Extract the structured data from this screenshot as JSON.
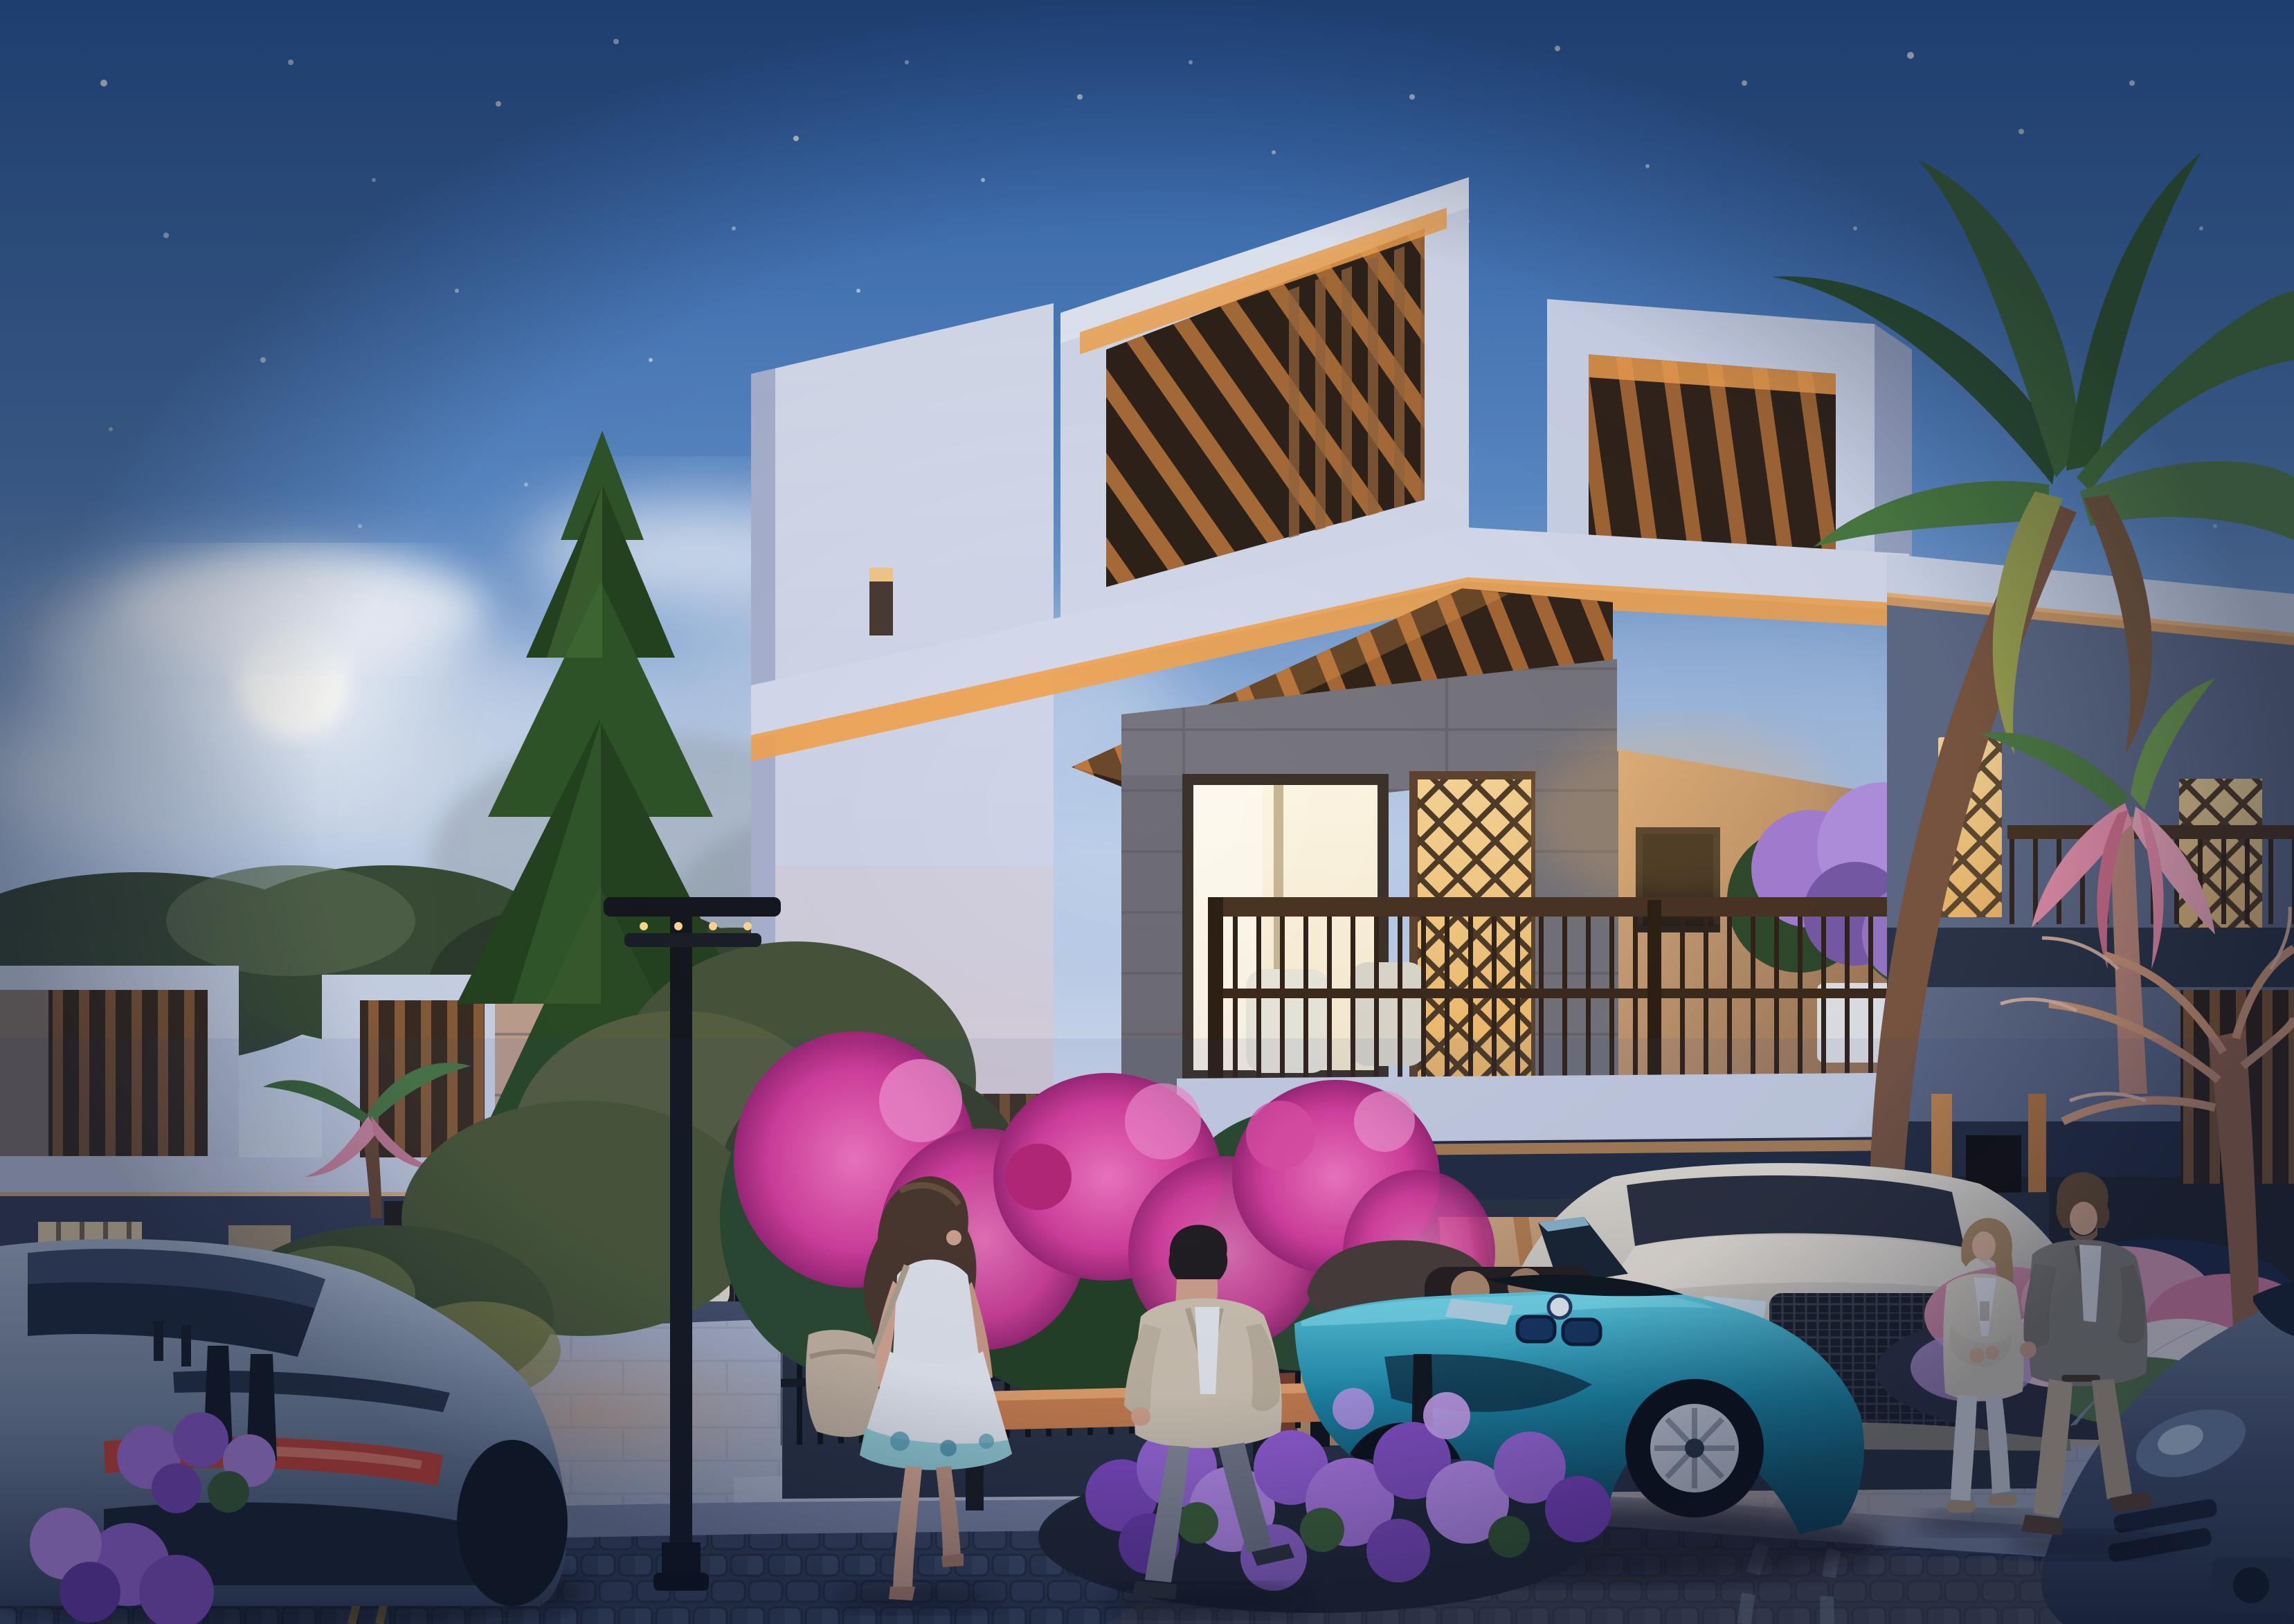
{
  "meta": {
    "title": "Twilight townhouse community - architectural rendering",
    "type": "photorealistic architectural visualization",
    "time_of_day": "dusk"
  },
  "palette": {
    "skyTop": "#2d5fa6",
    "skyMid": "#5b8ac6",
    "skyLow": "#a9c0e2",
    "horizon": "#dde5f2",
    "moonCore": "#fefefb",
    "cloud": "#e6edf8",
    "treeDark": "#2a4426",
    "treeMid": "#3a5c31",
    "treeLight": "#54804a",
    "dryTree": "#9fa9b4",
    "villaWhite": "#d8deee",
    "villaShade": "#a9b2cf",
    "fasciaGlow": "#f3a44f",
    "woodSlat": "#b5743c",
    "woodDark": "#6e4626",
    "stone": "#77767e",
    "windowGlow": "#f8ead0",
    "latticeGlow": "#efb969",
    "warmWall": "#c49a6e",
    "railWood": "#3c2b1d",
    "balconyFlower": "#a77fd4",
    "hedgePink": "#e03f9f",
    "hedgePinkLight": "#ff7ac5",
    "hedgeLeaf": "#2b4a2b",
    "hydrangea": "#a169dd",
    "hydrangeaLight": "#c18ff0",
    "hydrangeaDeep": "#7a3fbd",
    "leafGreen": "#3e6332",
    "benchWood": "#cf7f49",
    "iron": "#111419",
    "pavement": "#aab1c4",
    "curb": "#7d86a2",
    "cobble": "#333d52",
    "roadWarm": "#6e5e50",
    "laneYellow": "#d7a63e",
    "i8Teal": "#1a89a6",
    "i8TealHi": "#62d2e4",
    "i8Dark": "#0b3e52",
    "suvWhite": "#d9d2c6",
    "grilleDark": "#1a1d22",
    "amgGrey": "#8496ad",
    "amgTail": "#e0452e",
    "porsche": "#475571",
    "skin": "#dcab90",
    "hairBrown": "#4d3728",
    "hairBlond": "#b08c5f",
    "dressWhite": "#eceef2",
    "bagBeige": "#c9b7a0",
    "jacketBeige": "#d7cab3",
    "trouserGrey": "#8b8f9a",
    "blazerGrey": "#8e897f",
    "chinoBeige": "#c8b698",
    "pantsWhite": "#e9eaee",
    "cardiganCream": "#e5dcc9",
    "lampBlack": "#14171d",
    "palmGreen": "#3f6a39",
    "palmGreenDark": "#2c5030",
    "palmPink": "#ec93ad",
    "palmTrunk": "#7b5640",
    "pinkFlowerBed": "#f0aac6",
    "bareTree": "#d39a78"
  },
  "scene": {
    "setting": "Modern luxury townhouse community at dusk with glowing warm interior lights",
    "sky": {
      "time": "twilight",
      "stars": true,
      "moon": "full glowing moon among soft clouds, upper left"
    },
    "architecture": {
      "main_villa": "three-storey white contemporary villa, warm cove lighting under fascias, timber pergola roof decks, stone-clad columns, glowing picture window, backlit mashrabiya lattice screens, timber balcony railing with white chairs and purple planter",
      "left_row": "neighbouring two-storey townhouses with wood-slat roof boxes, lit windows, balcony and carport with two white cars",
      "right_unit": "adjoining unit with backlit lattice balcony screens, dark fascia bands and timber-slat ground floor entrance"
    },
    "vegetation": [
      "tall dark pine tree centre-left",
      "large green palm canopy top right",
      "pink uplit palm on the right",
      "small pink-lit palm beside the street lamp",
      "bougainvillea hedge spilling over black iron fence",
      "purple hydrangea bed in the foreground",
      "pink flower bed with bare warm-lit tree on the right",
      "background broadleaf trees and shrubs"
    ],
    "vehicles": [
      {
        "name": "teal BMW i8 roadster",
        "position": "driveway centre-right",
        "details": "open top, BMW roundel, twin-kidney grille, silver multi-spoke wheel"
      },
      {
        "name": "white SUV",
        "position": "parked behind the i8",
        "details": "large dark mesh grille"
      },
      {
        "name": "silver-grey sports coupe",
        "position": "foreground left, rear view",
        "details": "full-width red tail-light band"
      },
      {
        "name": "dark blue sports car",
        "position": "bottom right corner, front view"
      },
      {
        "name": "two white cars",
        "position": "left background carport"
      }
    ],
    "people": [
      {
        "name": "woman walking",
        "position": "centre-left sidewalk",
        "details": "long brown hair, white summer dress with teal hem, beige shoulder bag"
      },
      {
        "name": "man walking",
        "position": "centre, in front of bougainvillea fence",
        "details": "cream jacket, white shirt, grey trousers"
      },
      {
        "name": "couple talking",
        "position": "right, by the entrance",
        "details": "woman in cream cardigan and white trousers; bearded man in grey blazer and beige chinos"
      }
    ],
    "street_furniture": [
      "modern black street lamp",
      "black bollards",
      "wooden bench",
      "cobblestone road with curved paving arcs",
      "light paver sidewalk",
      "yellow lane line"
    ]
  }
}
